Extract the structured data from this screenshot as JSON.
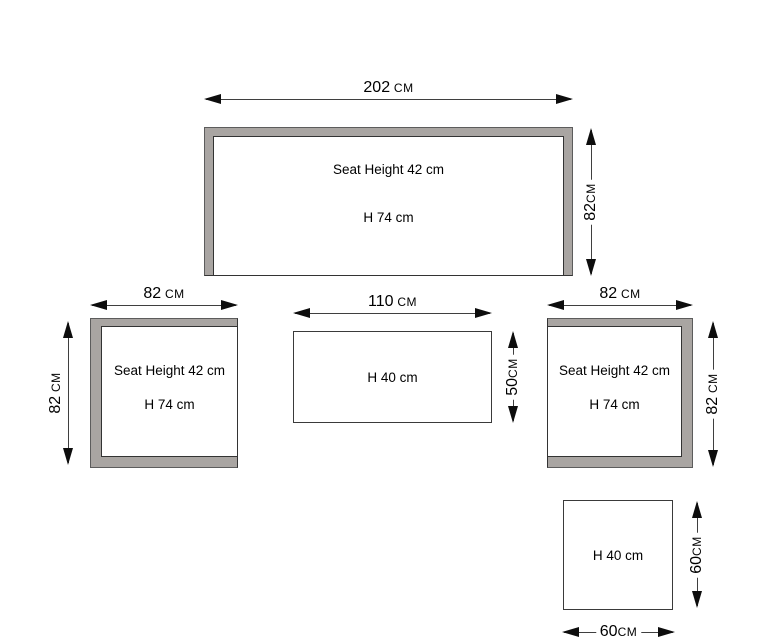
{
  "colors": {
    "background": "#ffffff",
    "shape_fill": "#a9a5a2",
    "shape_outline": "#333333",
    "dimension_line": "#3f3f3f",
    "arrow": "#0d0d0d",
    "text": "#000000"
  },
  "shapes": {
    "sofa": {
      "width": {
        "value": "202",
        "unit": " CM"
      },
      "depth": {
        "value": "82",
        "unit": "CM"
      },
      "seat_height_label": "Seat Height 42 cm",
      "height_label": "H 74 cm"
    },
    "left_chair": {
      "width": {
        "value": "82",
        "unit": " CM"
      },
      "depth": {
        "value": "82",
        "unit": " CM"
      },
      "seat_height_label": "Seat Height 42 cm",
      "height_label": "H 74 cm"
    },
    "coffee_table": {
      "width": {
        "value": "110",
        "unit": " CM"
      },
      "depth": {
        "value": "50",
        "unit": "CM"
      },
      "height_label": "H 40 cm"
    },
    "right_chair": {
      "width": {
        "value": "82",
        "unit": " CM"
      },
      "depth": {
        "value": "82",
        "unit": " CM"
      },
      "seat_height_label": "Seat Height 42 cm",
      "height_label": "H 74 cm"
    },
    "side_table": {
      "width": {
        "value": "60",
        "unit": "CM"
      },
      "depth": {
        "value": "60",
        "unit": "CM"
      },
      "height_label": "H 40 cm"
    }
  }
}
